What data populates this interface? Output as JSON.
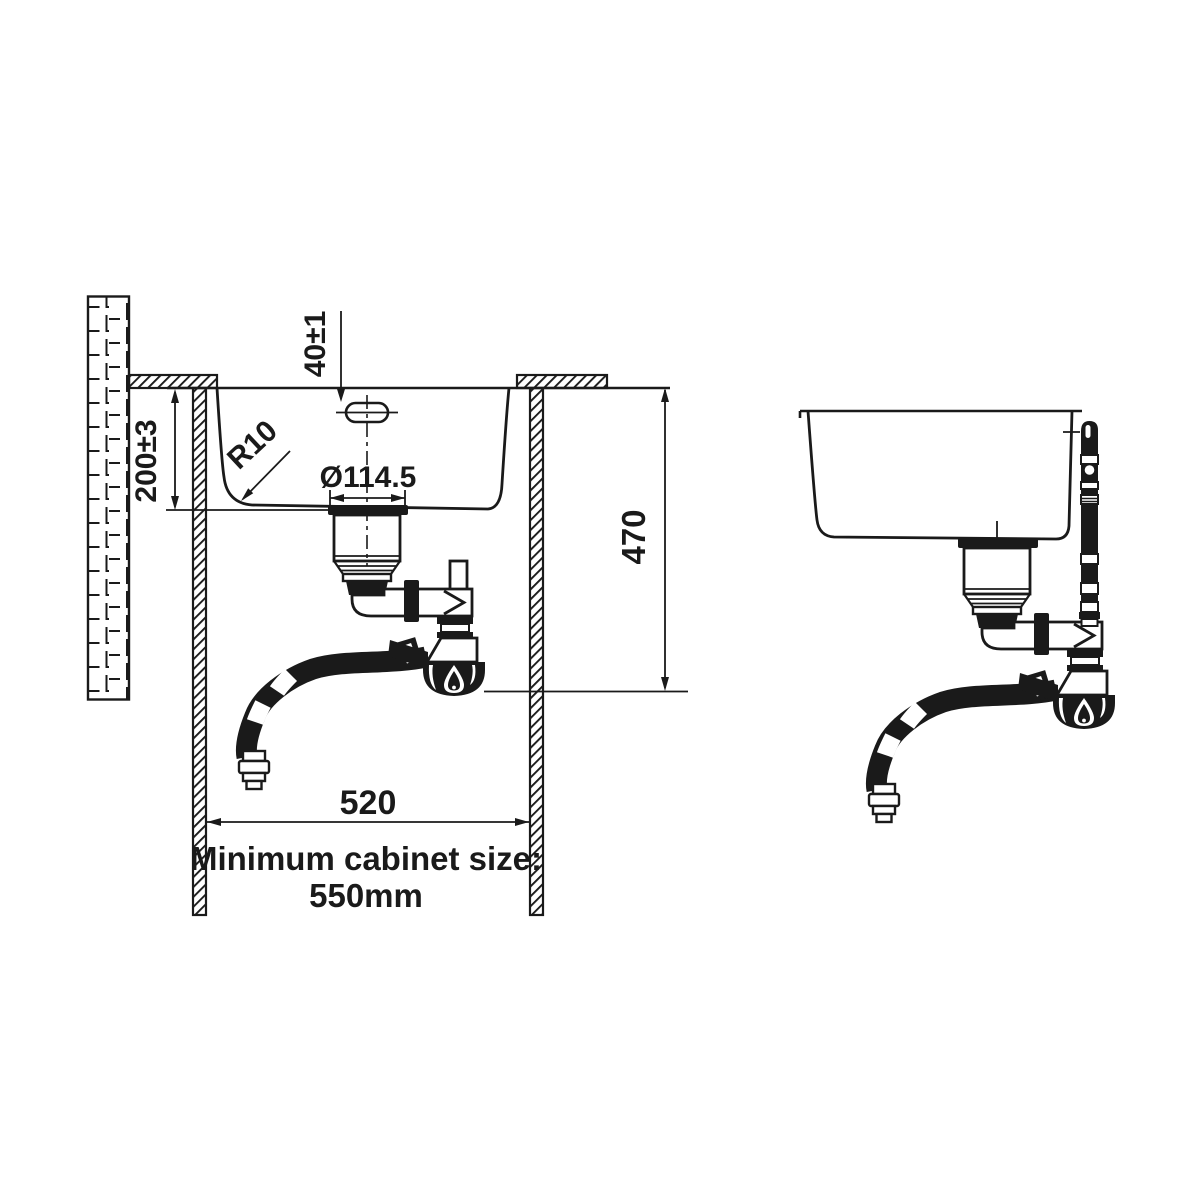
{
  "colors": {
    "ink": "#1a1a1a",
    "paper": "#ffffff"
  },
  "section_view": {
    "dim_overflow": "40±1",
    "dim_depth": "200±3",
    "dim_radius": "R10",
    "dim_drain": "Ø114.5",
    "dim_height": "470",
    "dim_width": "520",
    "note_line1": "Minimum cabinet size:",
    "note_line2": "550mm"
  }
}
